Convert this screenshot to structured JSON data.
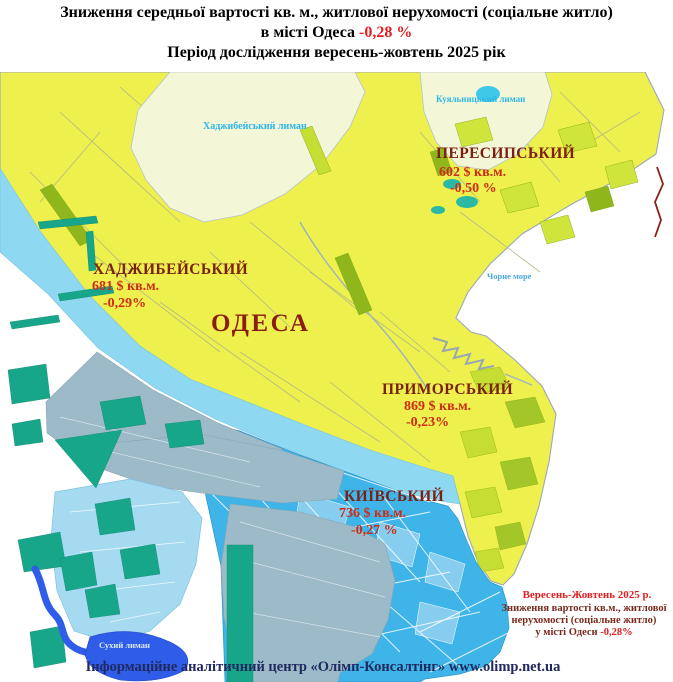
{
  "title": {
    "line1": "Зниження середньої вартості кв. м., житлової нерухомості (соціальне житло)",
    "line2_prefix": "в місті Одеса ",
    "line2_value": "-0,28 %",
    "line3": "Період дослідження вересень-жовтень 2025 рік"
  },
  "map": {
    "city": "ОДЕСА",
    "water": {
      "khadzhybei": "Хаджибейський лиман",
      "kuialnyk": "Куяльницький лиман",
      "black_sea": "Чорне море",
      "sukhyi": "Сухий лиман"
    },
    "districts": [
      {
        "name": "ПЕРЕСИПСЬКИЙ",
        "price": "602 $ кв.м.",
        "change": "-0,50 %"
      },
      {
        "name": "ХАДЖИБЕЙСЬКИЙ",
        "price": "681 $ кв.м.",
        "change": "-0,29%"
      },
      {
        "name": "ПРИМОРСЬКИЙ",
        "price": "869 $ кв.м.",
        "change": "-0,23%"
      },
      {
        "name": "КИЇВСЬКИЙ",
        "price": "736 $ кв.м.",
        "change": "-0,27 %"
      }
    ],
    "note": {
      "period": "Вересень-Жовтень 2025 р.",
      "line1": "Зниження вартості кв.м., житлової",
      "line2": "нерухомості (соціальне житло)",
      "line3_prefix": "у місті Одеси ",
      "line3_value": "-0,28%"
    }
  },
  "footer": "Інформаційне аналітичний центр «Олімп-Консалтінг» www.olimp.net.ua",
  "colors": {
    "accent_red": "#e31e1e",
    "district_name": "#7a2113",
    "district_value": "#cf2c18",
    "land_yellow": "#edf04d",
    "liman_pale": "#f3f7d8",
    "water_band": "#8ed8f1",
    "industrial_gray": "#9cbac8",
    "district_blue": "#3eb4e9",
    "tairove_blue": "#a6daf1",
    "teal_parcel": "#18a68a",
    "sukhyi_blue": "#2f5ce8",
    "water_label": "#2fb6e9",
    "footer_text": "#20295f"
  }
}
